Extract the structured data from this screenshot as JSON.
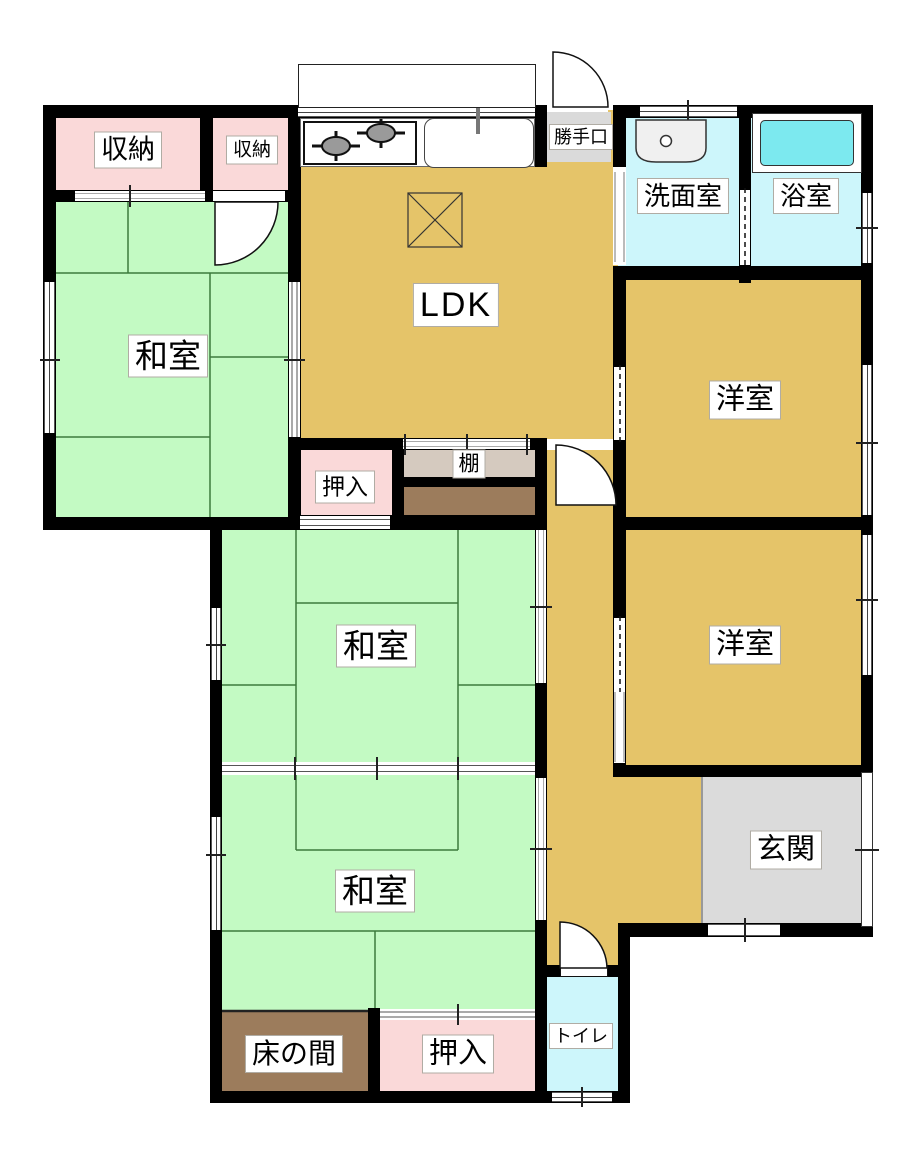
{
  "plan_title": "house-floor-plan",
  "rooms": {
    "ldk": {
      "label": "LDK"
    },
    "washitsu_upper": {
      "label": "和室"
    },
    "washitsu_middle": {
      "label": "和室"
    },
    "washitsu_bottom": {
      "label": "和室"
    },
    "youshitsu_upper": {
      "label": "洋室"
    },
    "youshitsu_lower": {
      "label": "洋室"
    },
    "shuunou_large": {
      "label": "収納"
    },
    "shuunou_small": {
      "label": "収納"
    },
    "oshiire_middle": {
      "label": "押入"
    },
    "oshiire_bottom": {
      "label": "押入"
    },
    "tana": {
      "label": "棚"
    },
    "senmenshitsu": {
      "label": "洗面室"
    },
    "yokushitsu": {
      "label": "浴室"
    },
    "toilet": {
      "label": "トイレ"
    },
    "genkan": {
      "label": "玄関"
    },
    "tokonoma": {
      "label": "床の間"
    },
    "katteguchi": {
      "label": "勝手口"
    }
  },
  "colors": {
    "tatami_green": "#C3FAC3",
    "tatami_line": "#3c7a3c",
    "closet_pink": "#FAD9D9",
    "flooring_tan": "#E5C469",
    "wet_cyan": "#CDF6FB",
    "bathtub_cyan": "#7CE9EF",
    "entrance_gray": "#DBDBDB",
    "tokonoma_brown": "#9C7C5C",
    "shelf_beige": "#D5CABF",
    "wall_black": "#000000"
  }
}
